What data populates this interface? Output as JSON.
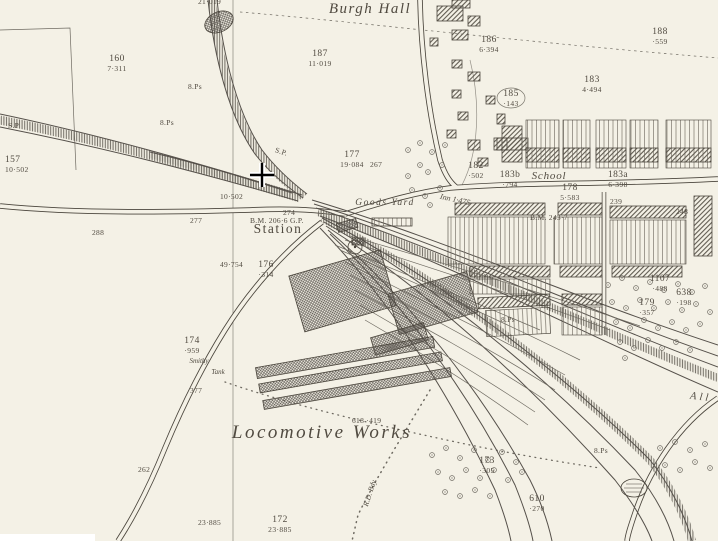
{
  "colors": {
    "paper": "#f4f1e6",
    "ink": "#4a453c",
    "label": "#504a40"
  },
  "names": {
    "burgh_hall": "Burgh Hall",
    "station": "Station",
    "goods_yard": "Goods Yard",
    "school": "School",
    "locomotive_works": "Locomotive Works",
    "inn": "Inn 1·475",
    "smithy": "Smithy",
    "tank": "Tank",
    "allotments_partial": "All",
    "rural_district_boundary": "R.D. Bdy."
  },
  "parcels": [
    {
      "number": "160",
      "acreage": "7·311"
    },
    {
      "number": "187",
      "acreage": "11·019"
    },
    {
      "number": "186",
      "acreage": "6·394"
    },
    {
      "number": "188",
      "acreage": "·559"
    },
    {
      "number": "183",
      "acreage": "4·494"
    },
    {
      "number": "185",
      "acreage": "·143"
    },
    {
      "number": "157",
      "acreage": "10·502"
    },
    {
      "number": "177",
      "acreage": "19·084"
    },
    {
      "number": "182",
      "acreage": "·502"
    },
    {
      "number": "183b",
      "acreage": "·794"
    },
    {
      "number": "178",
      "acreage": "5·583"
    },
    {
      "number": "183a",
      "acreage": "6·398"
    },
    {
      "number": "176",
      "acreage": "·314"
    },
    {
      "number": "174",
      "acreage": "·959"
    },
    {
      "number": "1107",
      "acreage": "·488"
    },
    {
      "number": "638",
      "acreage": "·198"
    },
    {
      "number": "179",
      "acreage": "·357"
    },
    {
      "number": "173",
      "acreage": "·305"
    },
    {
      "number": "610",
      "acreage": "·270"
    },
    {
      "number": "172",
      "acreage": "23·885"
    }
  ],
  "annotations": [
    {
      "text": "21·019"
    },
    {
      "text": "S.P"
    },
    {
      "text": "8.Ps"
    },
    {
      "text": "8.Ps"
    },
    {
      "text": "S.P."
    },
    {
      "text": "267"
    },
    {
      "text": "10·502"
    },
    {
      "text": "274"
    },
    {
      "text": "B.M. 206·6 G.P."
    },
    {
      "text": "B.M. 243·7"
    },
    {
      "text": "239"
    },
    {
      "text": "248"
    },
    {
      "text": "277"
    },
    {
      "text": "288"
    },
    {
      "text": "49·754"
    },
    {
      "text": "377"
    },
    {
      "text": "262"
    },
    {
      "text": "8.Ps"
    },
    {
      "text": "8.Ps"
    },
    {
      "text": "618 ·419"
    },
    {
      "text": "23·885"
    }
  ]
}
